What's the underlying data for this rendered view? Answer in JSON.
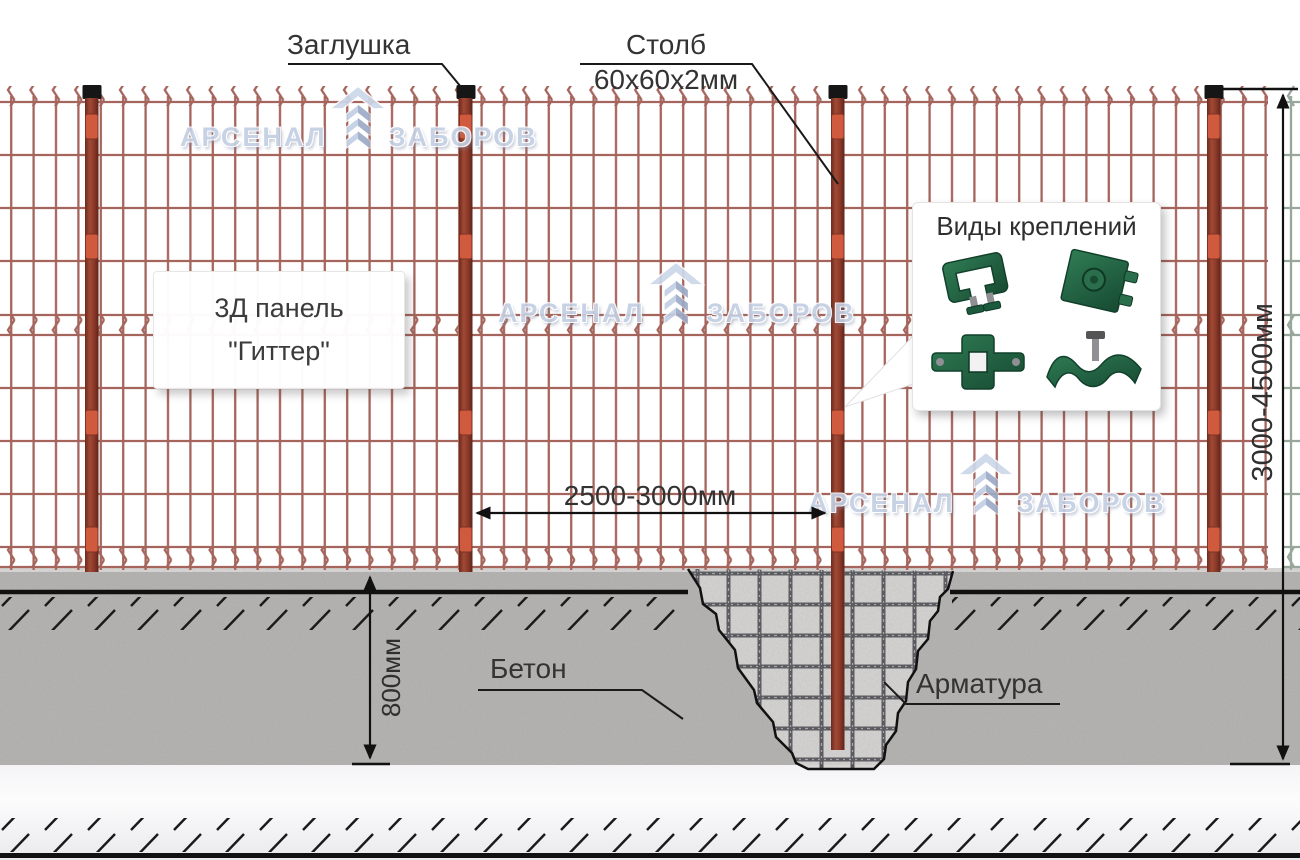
{
  "labels": {
    "cap": "Заглушка",
    "post": "Столб",
    "post_size": "60х60х2мм",
    "panel_line1": "3Д панель",
    "panel_line2": "\"Гиттер\"",
    "fasteners_title": "Виды креплений",
    "concrete": "Бетон",
    "rebar": "Арматура"
  },
  "dimensions": {
    "post_spacing": "2500-3000мм",
    "fence_height": "3000-4500мм",
    "foundation_depth": "800мм"
  },
  "watermark": {
    "word1": "АРСЕНАЛ",
    "word2": "ЗАБОРОВ"
  },
  "icons": [
    "chevron-logo-icon",
    "u-bracket-fastener-icon",
    "plate-fastener-icon",
    "cross-bracket-fastener-icon",
    "wave-clamp-fastener-icon"
  ],
  "colors": {
    "mesh": "#a5655c",
    "back_mesh": "#98a69c",
    "post": "#94402f",
    "post_cap": "#161616",
    "clamp": "#cf5a3d",
    "concrete": "#b5b4b2",
    "pit_fill": "#d7d6d4",
    "rebar": "#54545a",
    "dimension_line": "#1a1a1a",
    "watermark": "#c3cfe3",
    "fastener_green": "#1f5c3f"
  }
}
